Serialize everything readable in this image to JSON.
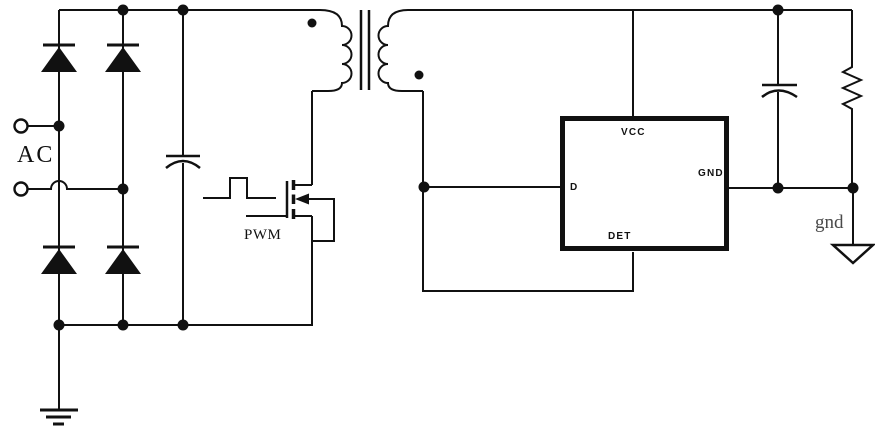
{
  "labels": {
    "ac": "AC",
    "pwm": "PWM",
    "gnd_output": "gnd"
  },
  "ic": {
    "vcc": "VCC",
    "d": "D",
    "gnd": "GND",
    "det": "DET"
  },
  "colors": {
    "line": "#111111",
    "gnd_text": "#4a4a4a",
    "background": "#ffffff"
  },
  "components": [
    "ac-input-terminals",
    "bridge-rectifier-diodes",
    "bulk-capacitor",
    "pwm-pulse-symbol",
    "power-mosfet",
    "flyback-transformer",
    "controller-ic",
    "output-capacitor",
    "load-resistor",
    "earth-ground-symbol",
    "output-ground-symbol"
  ]
}
